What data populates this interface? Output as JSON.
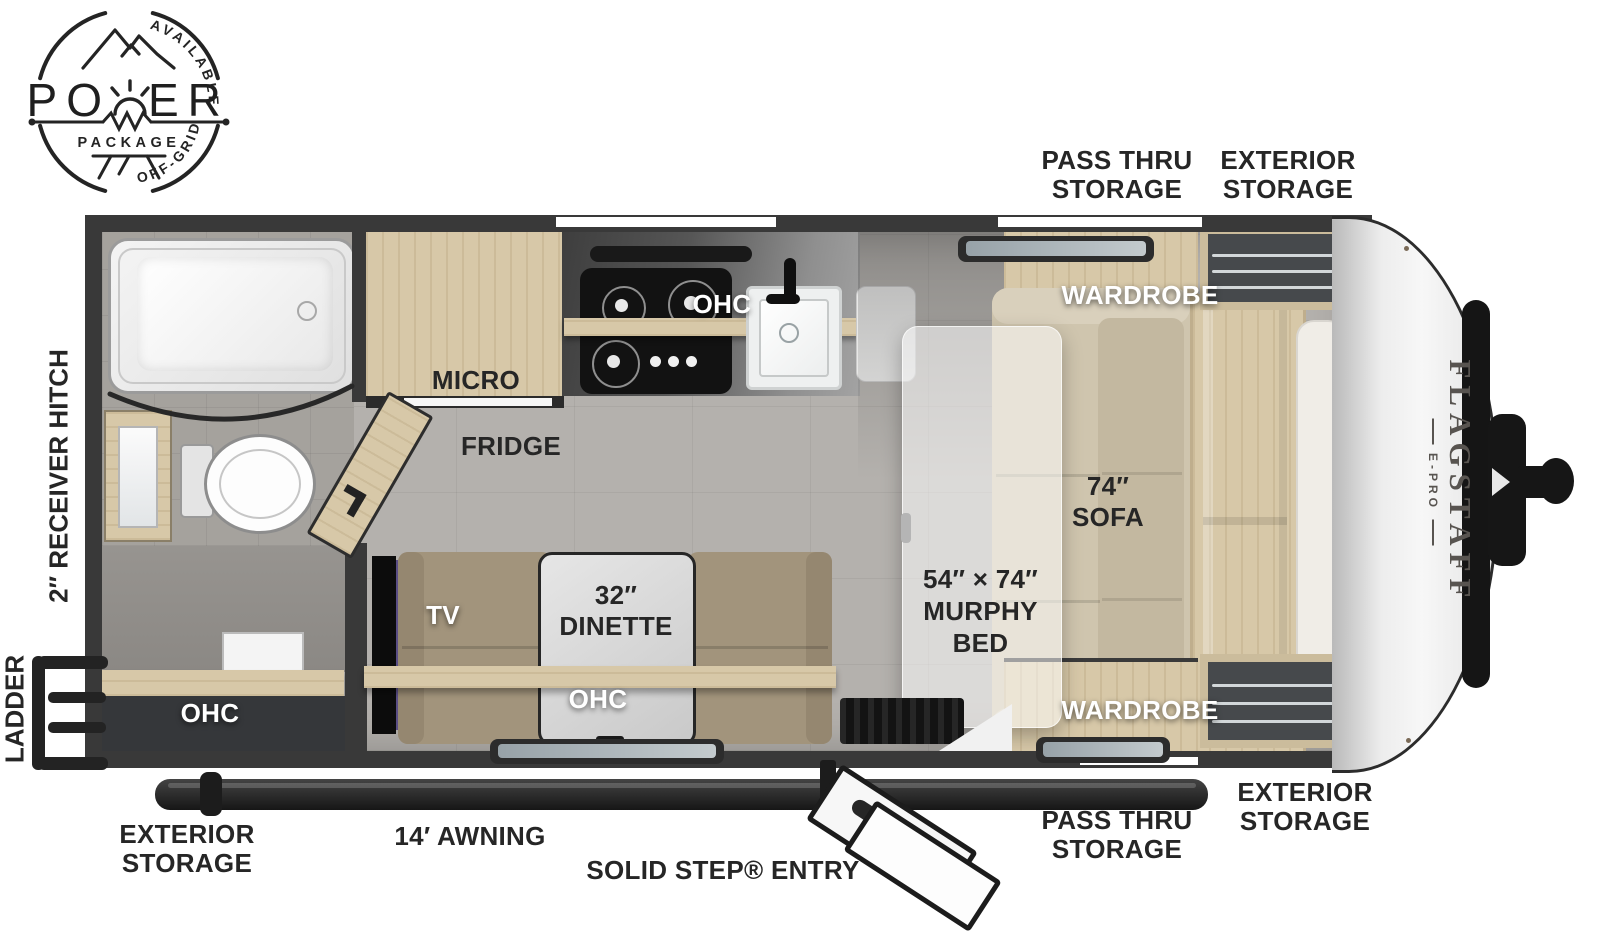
{
  "colors": {
    "wall": "#393939",
    "floor": "#b4b1ad",
    "wood": "#d7c8a8",
    "sofa": "#cfc5ae",
    "bench": "#a2947c",
    "label_dark": "#262626",
    "label_white": "#ffffff",
    "accent_black": "#161616"
  },
  "badge": {
    "arc_top": "AVAILABLE WITH",
    "title_left": "PO",
    "title_right": "ER",
    "subtitle": "PACKAGE",
    "arc_bottom": "OFF-GRID OPTIONS"
  },
  "brand": {
    "name": "FLAGSTAFF",
    "model": "E-PRO"
  },
  "exterior_labels": {
    "top_pass_thru": "PASS THRU STORAGE",
    "top_exterior": "EXTERIOR STORAGE",
    "left_hitch": "2″ RECEIVER HITCH",
    "left_ladder": "LADDER",
    "bottom_exterior_left": "EXTERIOR STORAGE",
    "bottom_awning": "14′ AWNING",
    "bottom_entry": "SOLID STEP® ENTRY",
    "bottom_pass_thru": "PASS THRU STORAGE",
    "bottom_exterior_right": "EXTERIOR STORAGE"
  },
  "interior_labels": {
    "micro": "MICRO",
    "fridge": "FRIDGE",
    "kitchen_ohc": "OHC",
    "rear_ohc": "OHC",
    "tv": "TV",
    "dinette_size": "32″",
    "dinette_name": "DINETTE",
    "dinette_ohc": "OHC",
    "wardrobe_top": "WARDROBE",
    "wardrobe_bottom": "WARDROBE",
    "sofa_size": "74″",
    "sofa_name": "SOFA",
    "murphy_size": "54″ × 74″",
    "murphy_line1": "MURPHY",
    "murphy_line2": "BED"
  }
}
